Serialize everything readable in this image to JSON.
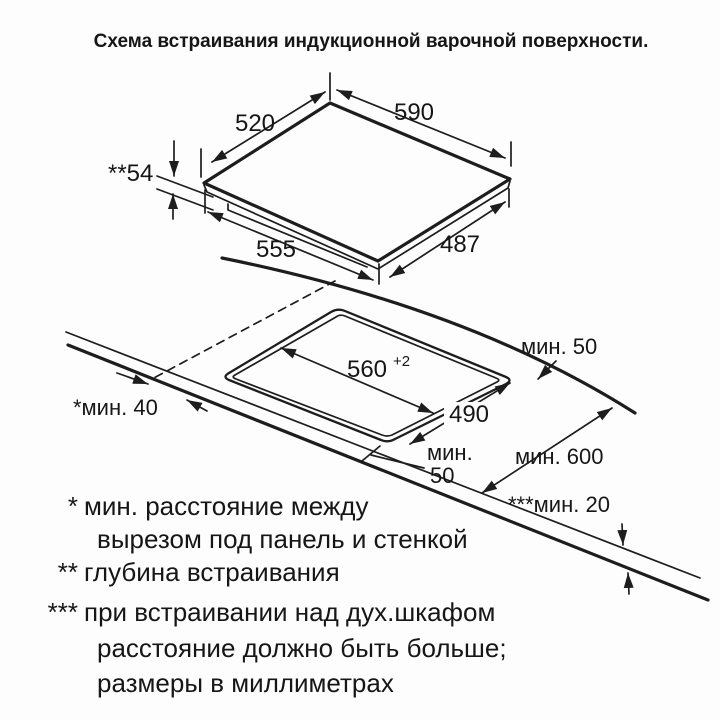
{
  "title": "Схема встраивания индукционной варочной поверхности.",
  "panel": {
    "top_width": "590",
    "left_width": "520",
    "front_width": "555",
    "right_depth": "487",
    "embed_depth": "**54"
  },
  "cutout": {
    "width": "560",
    "width_tolerance": "+2",
    "depth": "490",
    "back_clearance": "мин. 50",
    "front_clearance_line1": "мин.",
    "front_clearance_line2": "50",
    "side_clearance": "*мин. 40",
    "countertop_depth": "мин. 600",
    "bottom_clearance": "***мин. 20"
  },
  "footnotes": [
    {
      "marker": "*",
      "line1": "мин. расстояние между",
      "line2": "вырезом под панель и стенкой"
    },
    {
      "marker": "**",
      "line1": "глубина встраивания"
    },
    {
      "marker": "***",
      "line1": "при встраивании над дух.шкафом",
      "line2": "расстояние должно быть больше;",
      "line3": "размеры в миллиметрах"
    }
  ]
}
